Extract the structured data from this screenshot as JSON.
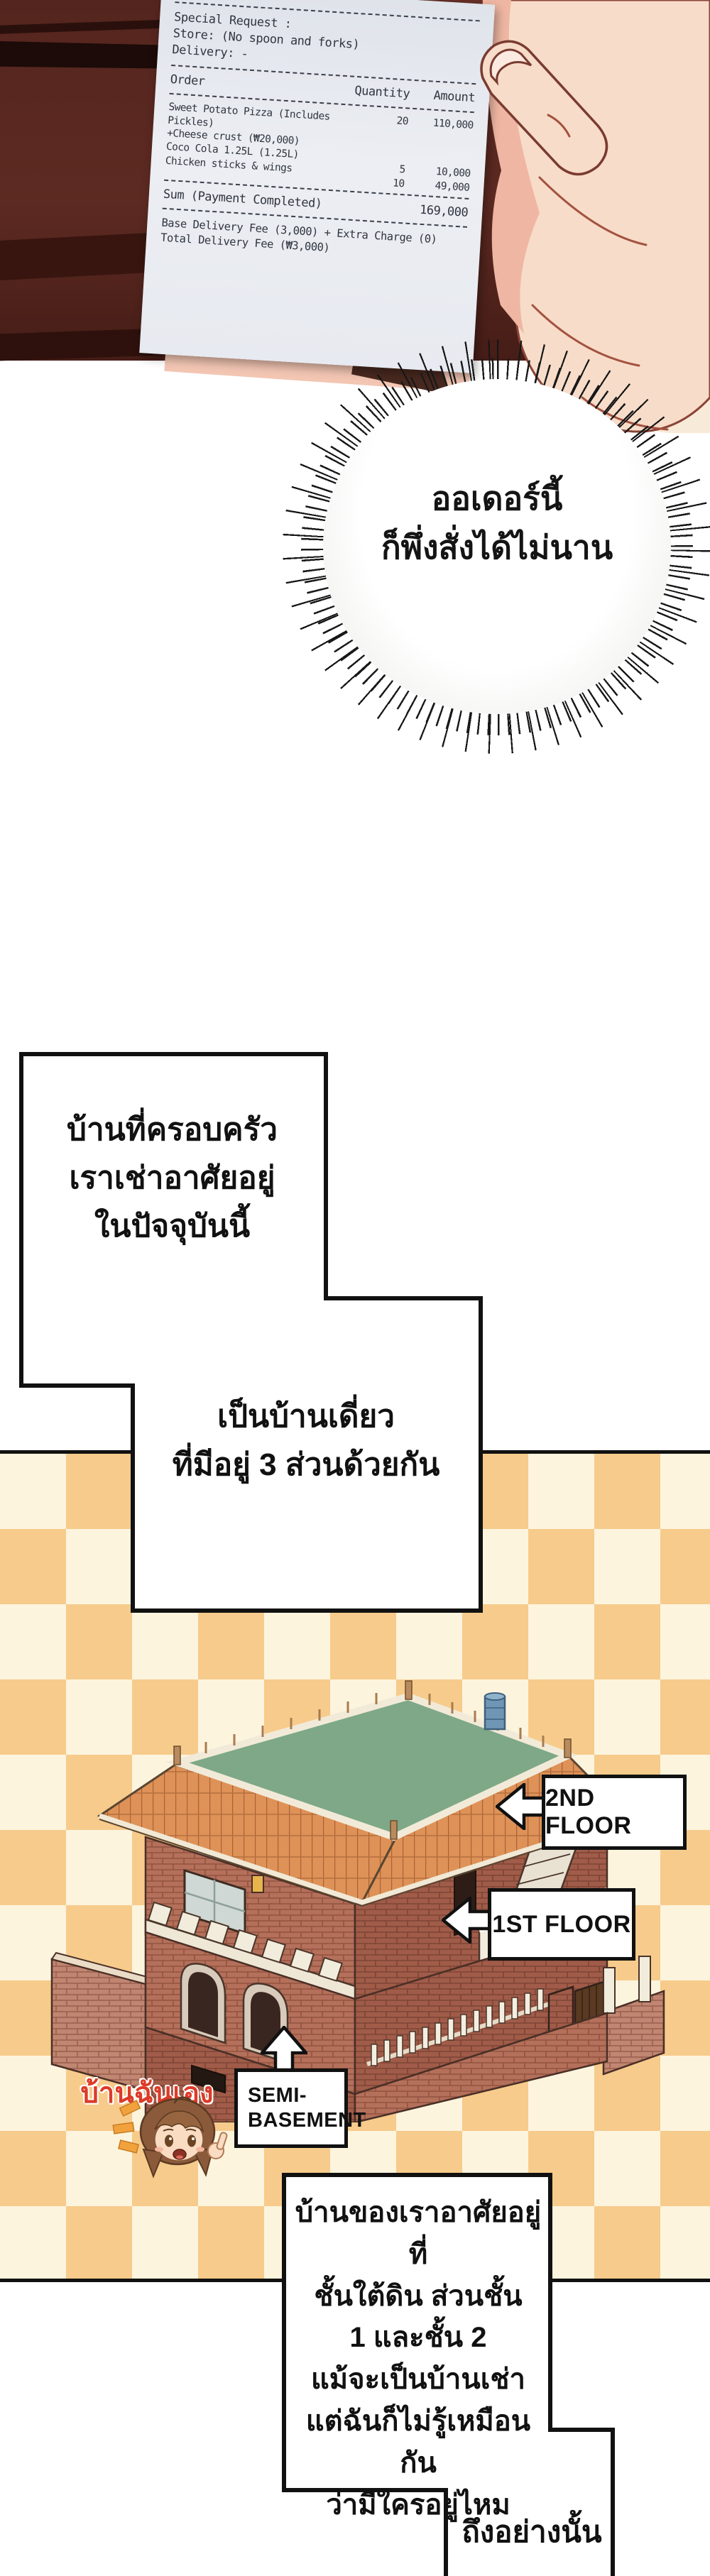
{
  "receipt": {
    "special_request_label": "Special Request :",
    "store_line": "Store: (No spoon and forks)",
    "delivery_line": "Delivery: -",
    "columns": {
      "order": "Order",
      "quantity": "Quantity",
      "amount": "Amount"
    },
    "items": [
      {
        "name": "Sweet Potato Pizza (Includes Pickles)",
        "note": "+Cheese crust (₩20,000)",
        "qty": "20",
        "amount": "110,000"
      },
      {
        "name": "Coco Cola 1.25L (1.25L)",
        "note": "",
        "qty": "5",
        "amount": "10,000"
      },
      {
        "name": "Chicken sticks & wings",
        "note": "",
        "qty": "10",
        "amount": "49,000"
      }
    ],
    "sum_label": "Sum (Payment Completed)",
    "sum_value": "169,000",
    "fee_line1": "Base Delivery Fee (3,000) + Extra Charge (0)",
    "fee_line2": "Total Delivery Fee (₩3,000)"
  },
  "speech_bubble": {
    "line1": "ออเดอร์นี้",
    "line2": "ก็พึ่งสั่งได้ไม่นาน"
  },
  "caption1": {
    "line1": "บ้านที่ครอบครัว",
    "line2": "เราเช่าอาศัยอยู่",
    "line3": "ในปัจจุบันนี้"
  },
  "caption2": {
    "line1": "เป็นบ้านเดี่ยว",
    "line2": "ที่มีอยู่ 3 ส่วนด้วยกัน"
  },
  "house_labels": {
    "second_floor": "2ND FLOOR",
    "first_floor": "1ST FLOOR",
    "semi_basement_line1": "SEMI-",
    "semi_basement_line2": "BASEMENT",
    "my_house": "บ้านฉันเอง"
  },
  "caption3": {
    "line1": "บ้านของเราอาศัยอยู่ที่",
    "line2": "ชั้นใต้ดิน ส่วนชั้น",
    "line3": "1 และชั้น 2",
    "line4": "แม้จะเป็นบ้านเช่า",
    "line5": "แต่ฉันก็ไม่รู้เหมือนกัน",
    "line6": "ว่ามีใครอยู่ไหม"
  },
  "caption4": {
    "line1": "ถึงอย่างนั้น"
  },
  "colors": {
    "checker_orange": "#f7cb8b",
    "checker_cream": "#fdf4de",
    "brick": "#b4705b",
    "roof_orange": "#de9257",
    "rooftop_green": "#7ea887",
    "label_red": "#dd3a28",
    "panel_dark": "#54251e",
    "skin": "#f7dcc9"
  }
}
